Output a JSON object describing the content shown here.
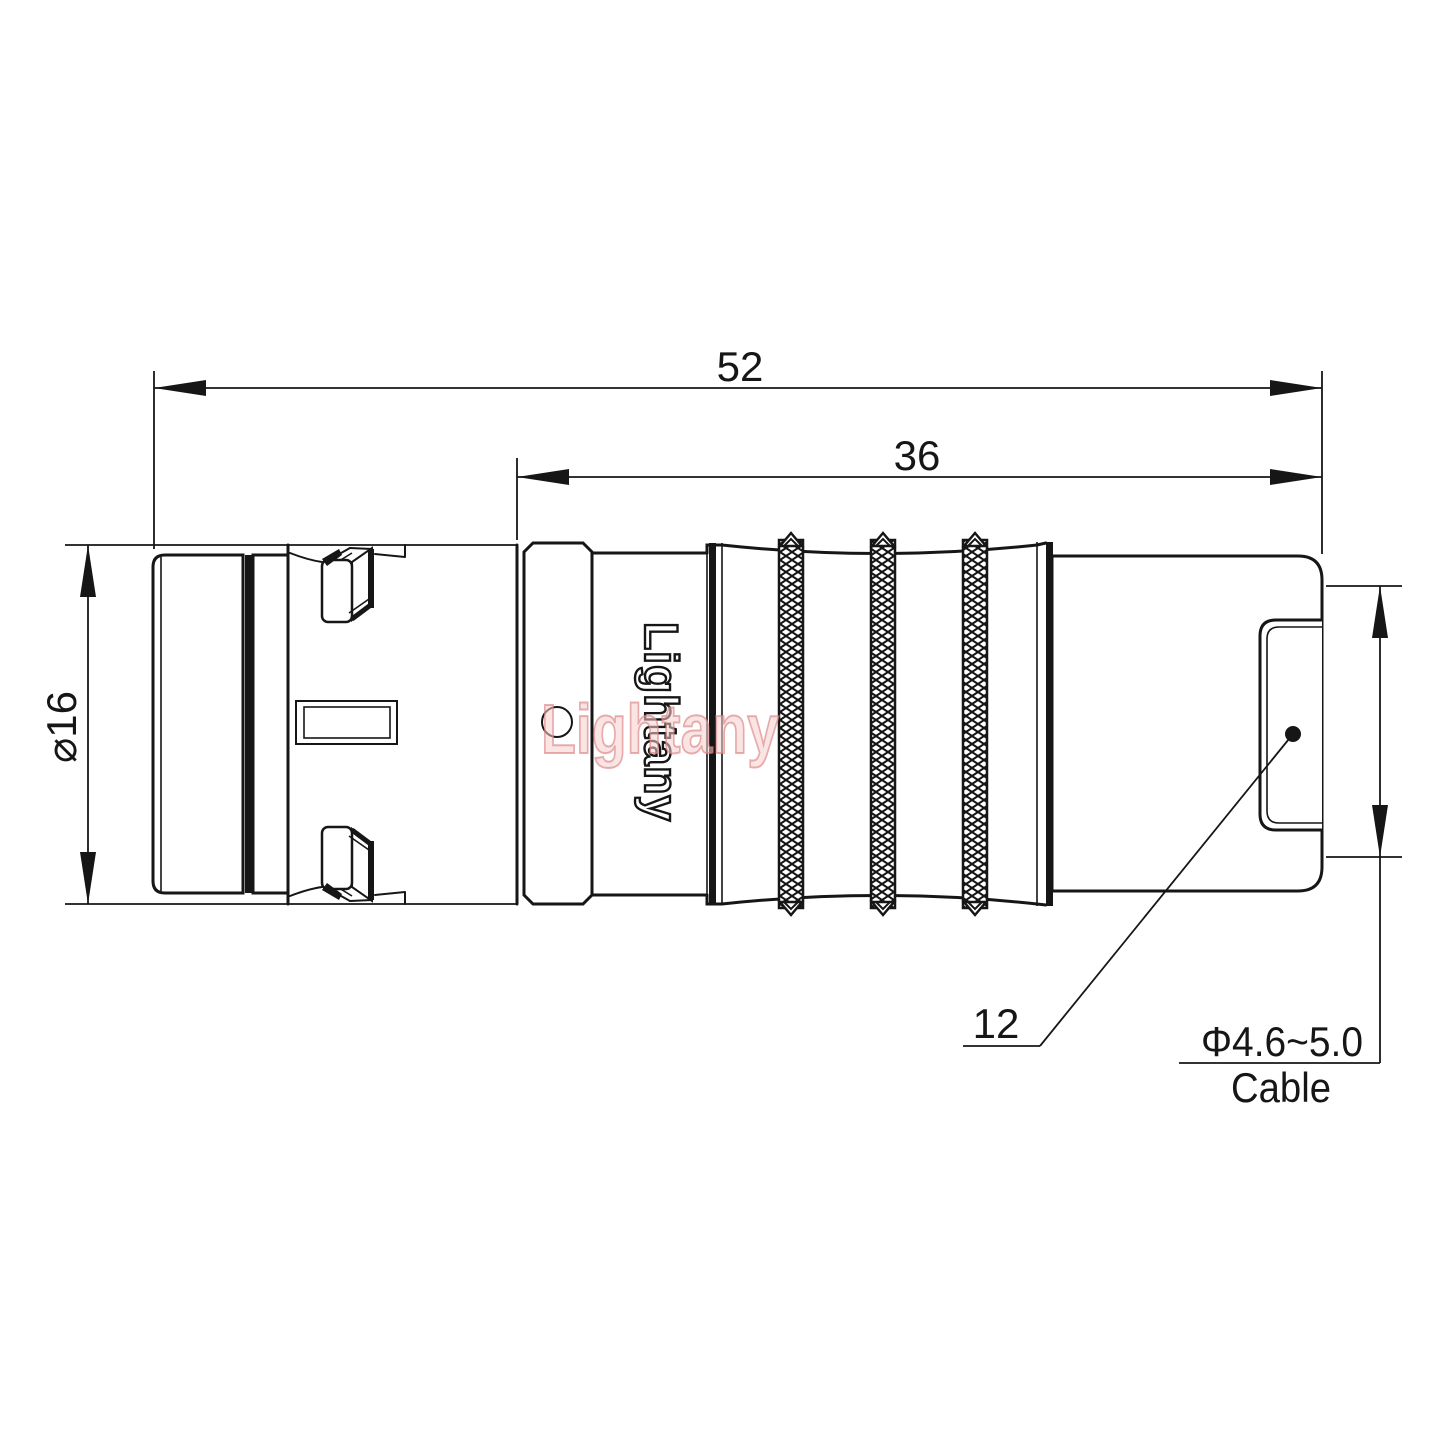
{
  "drawing": {
    "type": "technical-drawing",
    "subject": "cable connector side view",
    "logo_text": "Lightany",
    "watermark_text": "Lightany",
    "colors": {
      "background": "#ffffff",
      "line": "#161616",
      "watermark": "#dd8585"
    },
    "dimensions": {
      "overall_length": "52",
      "rear_length": "36",
      "body_diameter": "⌀16",
      "boot_ref": "12",
      "cable_range": "Φ4.6~5.0",
      "cable_word": "Cable"
    }
  }
}
